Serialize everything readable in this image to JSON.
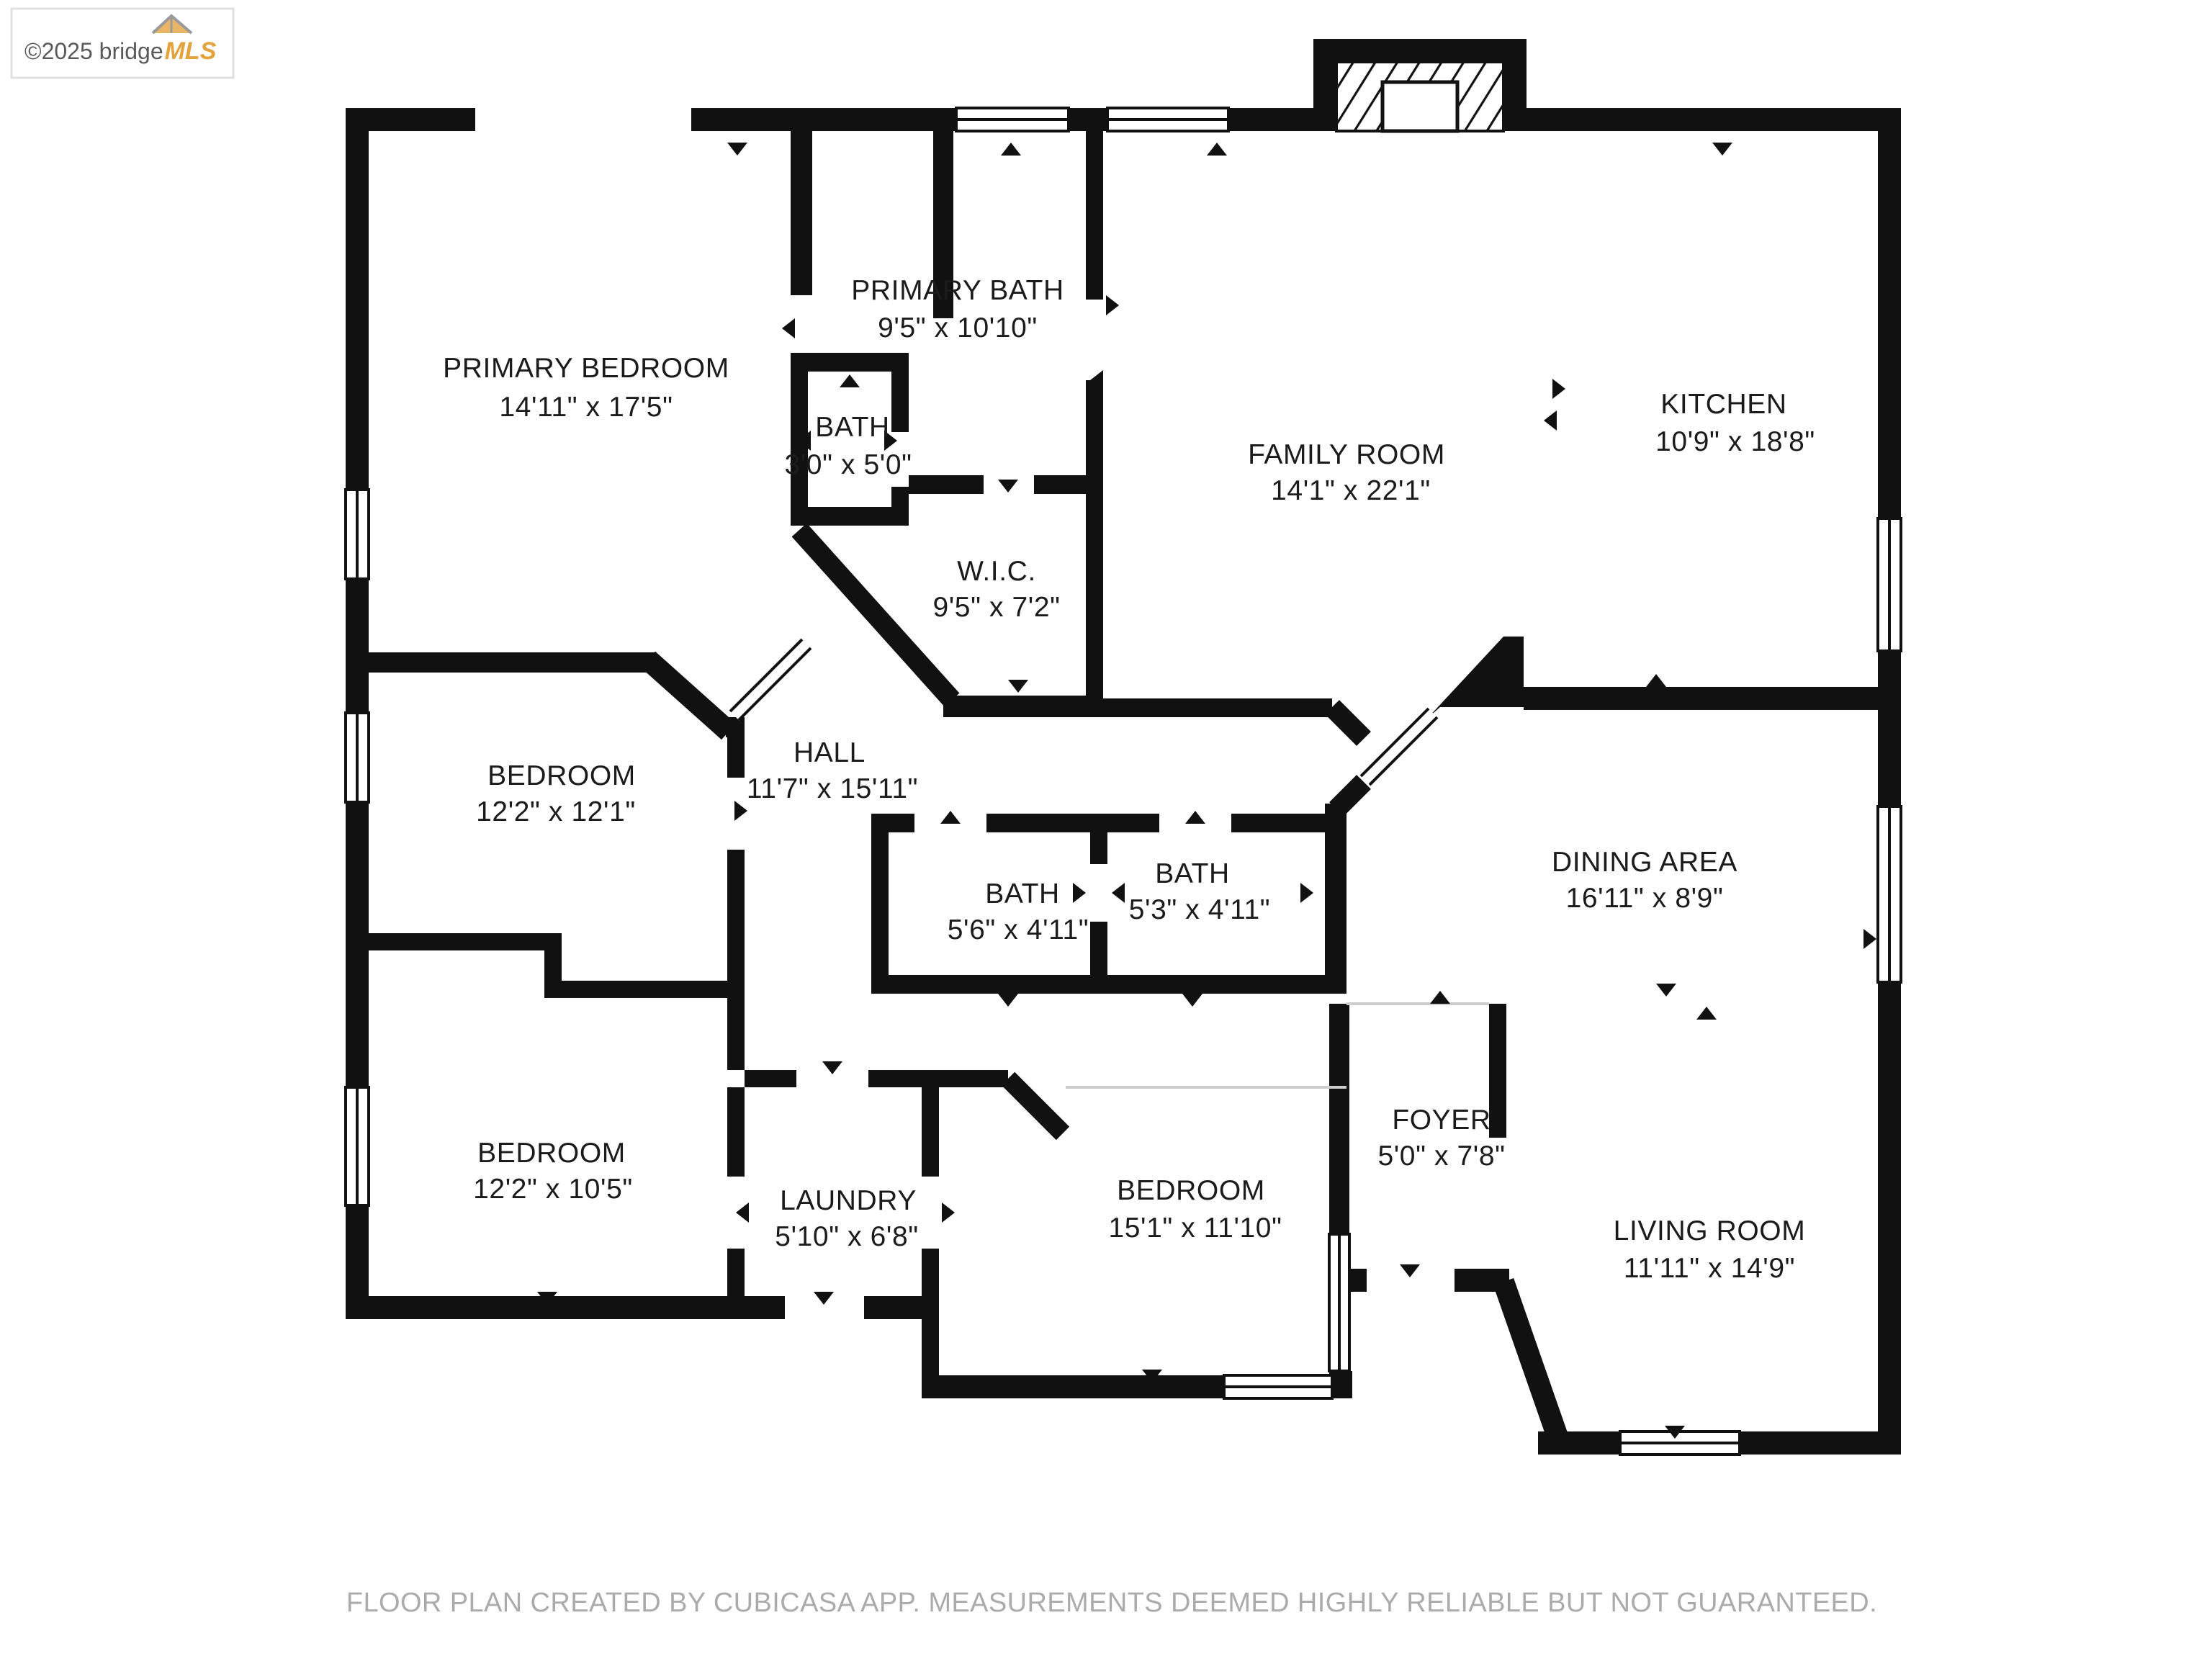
{
  "watermark": {
    "copyright": "©2025 bridge",
    "brand": "MLS"
  },
  "footer": {
    "text": "FLOOR PLAN CREATED BY CUBICASA APP. MEASUREMENTS DEEMED HIGHLY RELIABLE BUT NOT GUARANTEED."
  },
  "colors": {
    "wall": "#111111",
    "background": "#ffffff",
    "footer_text": "#ababab",
    "brand_orange": "#e4a23c",
    "logo_gray": "#58595b"
  },
  "rooms": [
    {
      "id": "primary-bedroom",
      "name": "PRIMARY BEDROOM",
      "dims": "14'11\" x 17'5\""
    },
    {
      "id": "primary-bath",
      "name": "PRIMARY BATH",
      "dims": "9'5\" x 10'10\""
    },
    {
      "id": "bath-small",
      "name": "BATH",
      "dims": "3'0\" x 5'0\""
    },
    {
      "id": "wic",
      "name": "W.I.C.",
      "dims": "9'5\" x 7'2\""
    },
    {
      "id": "family-room",
      "name": "FAMILY ROOM",
      "dims": "14'1\" x 22'1\""
    },
    {
      "id": "kitchen",
      "name": "KITCHEN",
      "dims": "10'9\" x 18'8\""
    },
    {
      "id": "hall",
      "name": "HALL",
      "dims": "11'7\" x 15'11\""
    },
    {
      "id": "bedroom-upper",
      "name": "BEDROOM",
      "dims": "12'2\" x 12'1\""
    },
    {
      "id": "bath-1",
      "name": "BATH",
      "dims": "5'6\" x 4'11\""
    },
    {
      "id": "bath-2",
      "name": "BATH",
      "dims": "5'3\" x 4'11\""
    },
    {
      "id": "dining-area",
      "name": "DINING AREA",
      "dims": "16'11\" x 8'9\""
    },
    {
      "id": "bedroom-lower",
      "name": "BEDROOM",
      "dims": "12'2\" x 10'5\""
    },
    {
      "id": "laundry",
      "name": "LAUNDRY",
      "dims": "5'10\" x 6'8\""
    },
    {
      "id": "bedroom-middle",
      "name": "BEDROOM",
      "dims": "15'1\" x 11'10\""
    },
    {
      "id": "foyer",
      "name": "FOYER",
      "dims": "5'0\" x 7'8\""
    },
    {
      "id": "living-room",
      "name": "LIVING ROOM",
      "dims": "11'11\" x 14'9\""
    }
  ]
}
